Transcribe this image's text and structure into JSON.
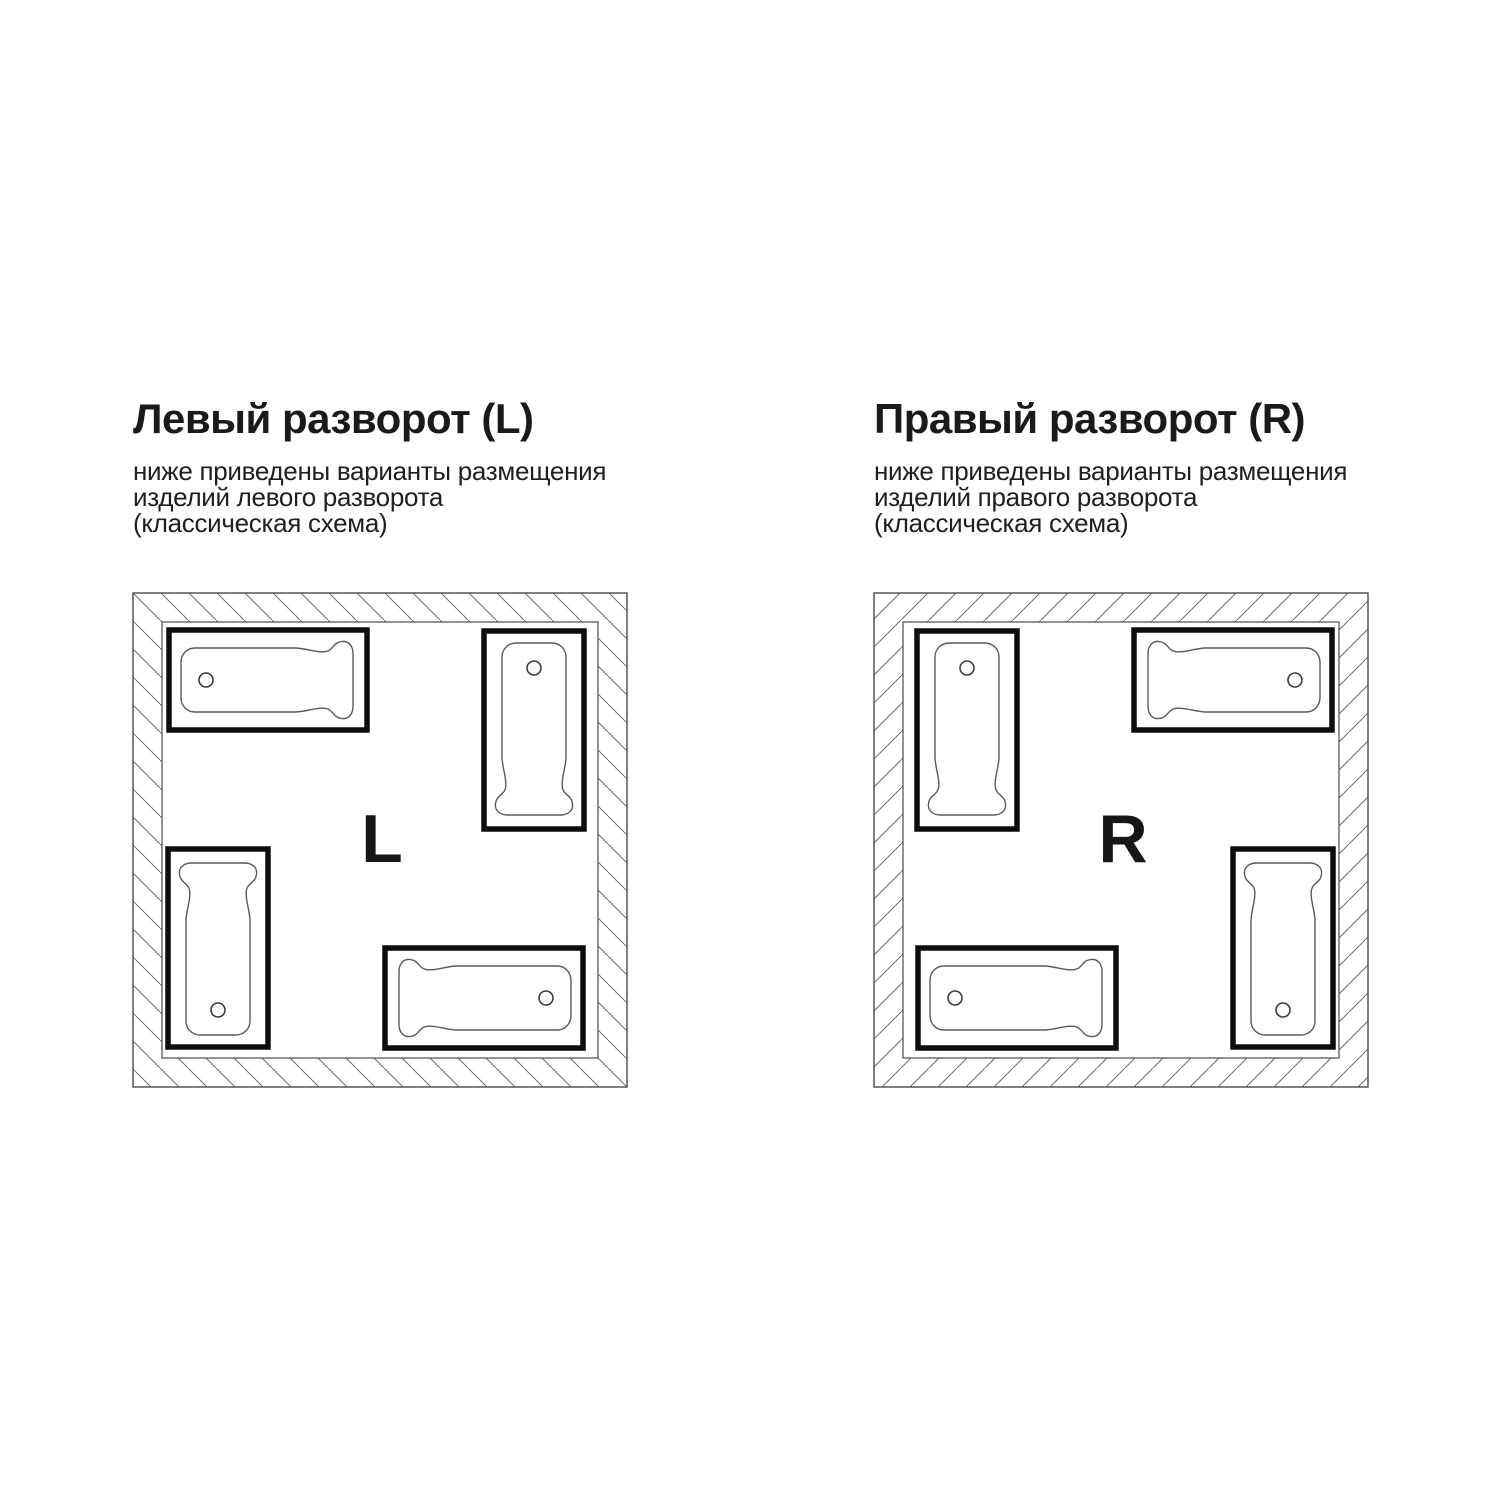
{
  "page": {
    "background": "#ffffff",
    "language": "ru",
    "kind": "bathtub-installation-scheme"
  },
  "colors": {
    "text": "#1a1a1a",
    "outline": "#4a4a4a",
    "hatch_line": "#6e6e6e",
    "tub_frame": "#0d0d0d",
    "tub_basin_line": "#5a5a5a"
  },
  "panels": [
    {
      "id": "left-orientation",
      "title": "Левый разворот (L)",
      "description_lines": [
        "ниже приведены варианты размещения",
        "изделий левого разворота",
        "(классическая схема)"
      ],
      "room_letter": "L",
      "hatch_direction": "backslash",
      "bathtubs": [
        {
          "position": "top-left",
          "orientation": "horizontal",
          "drain": "left"
        },
        {
          "position": "top-right",
          "orientation": "vertical",
          "drain": "top"
        },
        {
          "position": "bottom-left",
          "orientation": "vertical",
          "drain": "bottom"
        },
        {
          "position": "bottom-right",
          "orientation": "horizontal",
          "drain": "right"
        }
      ]
    },
    {
      "id": "right-orientation",
      "title": "Правый разворот (R)",
      "description_lines": [
        "ниже приведены варианты размещения",
        "изделий правого разворота",
        "(классическая схема)"
      ],
      "room_letter": "R",
      "hatch_direction": "slash",
      "bathtubs": [
        {
          "position": "top-left",
          "orientation": "vertical",
          "drain": "top"
        },
        {
          "position": "top-right",
          "orientation": "horizontal",
          "drain": "right"
        },
        {
          "position": "bottom-left",
          "orientation": "horizontal",
          "drain": "left"
        },
        {
          "position": "bottom-right",
          "orientation": "vertical",
          "drain": "bottom"
        }
      ]
    }
  ]
}
